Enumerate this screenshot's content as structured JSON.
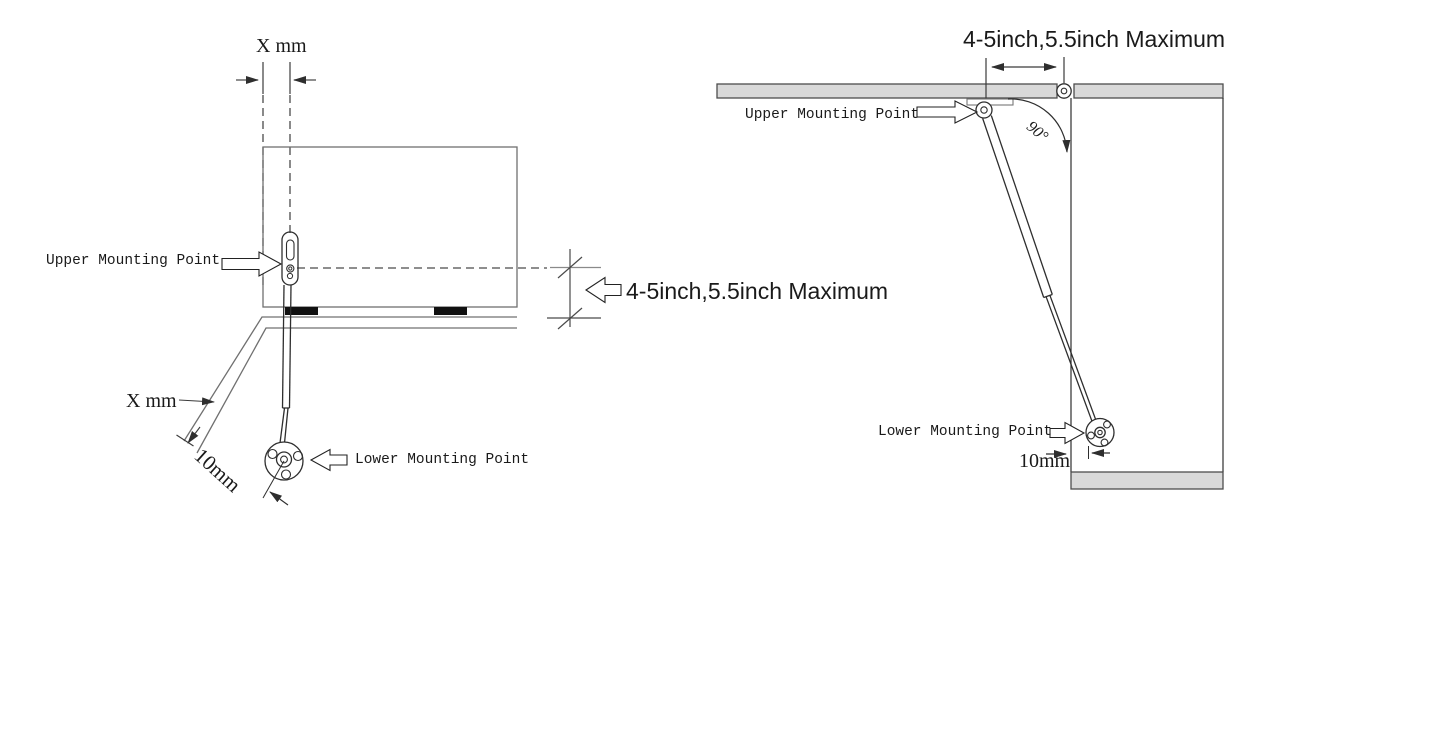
{
  "left_diagram": {
    "top_offset_label": "X mm",
    "upper_mounting_label": "Upper Mounting Point",
    "mounting_depth_label": "4-5inch,5.5inch Maximum",
    "door_edge_offset_label": "X mm",
    "lower_offset_label": "10mm",
    "lower_mounting_label": "Lower Mounting Point"
  },
  "right_diagram": {
    "mounting_depth_label": "4-5inch,5.5inch Maximum",
    "upper_mounting_label": "Upper Mounting Point",
    "open_angle_label": "90°",
    "lower_mounting_label": "Lower Mounting Point",
    "lower_offset_label": "10mm"
  },
  "colors": {
    "background": "#ffffff",
    "line_dark": "#2e2e2e",
    "line_gray": "#707070",
    "panel_fill": "#d9d9d9",
    "panel_border": "#4d4d4d",
    "pad_fill": "#111111"
  }
}
